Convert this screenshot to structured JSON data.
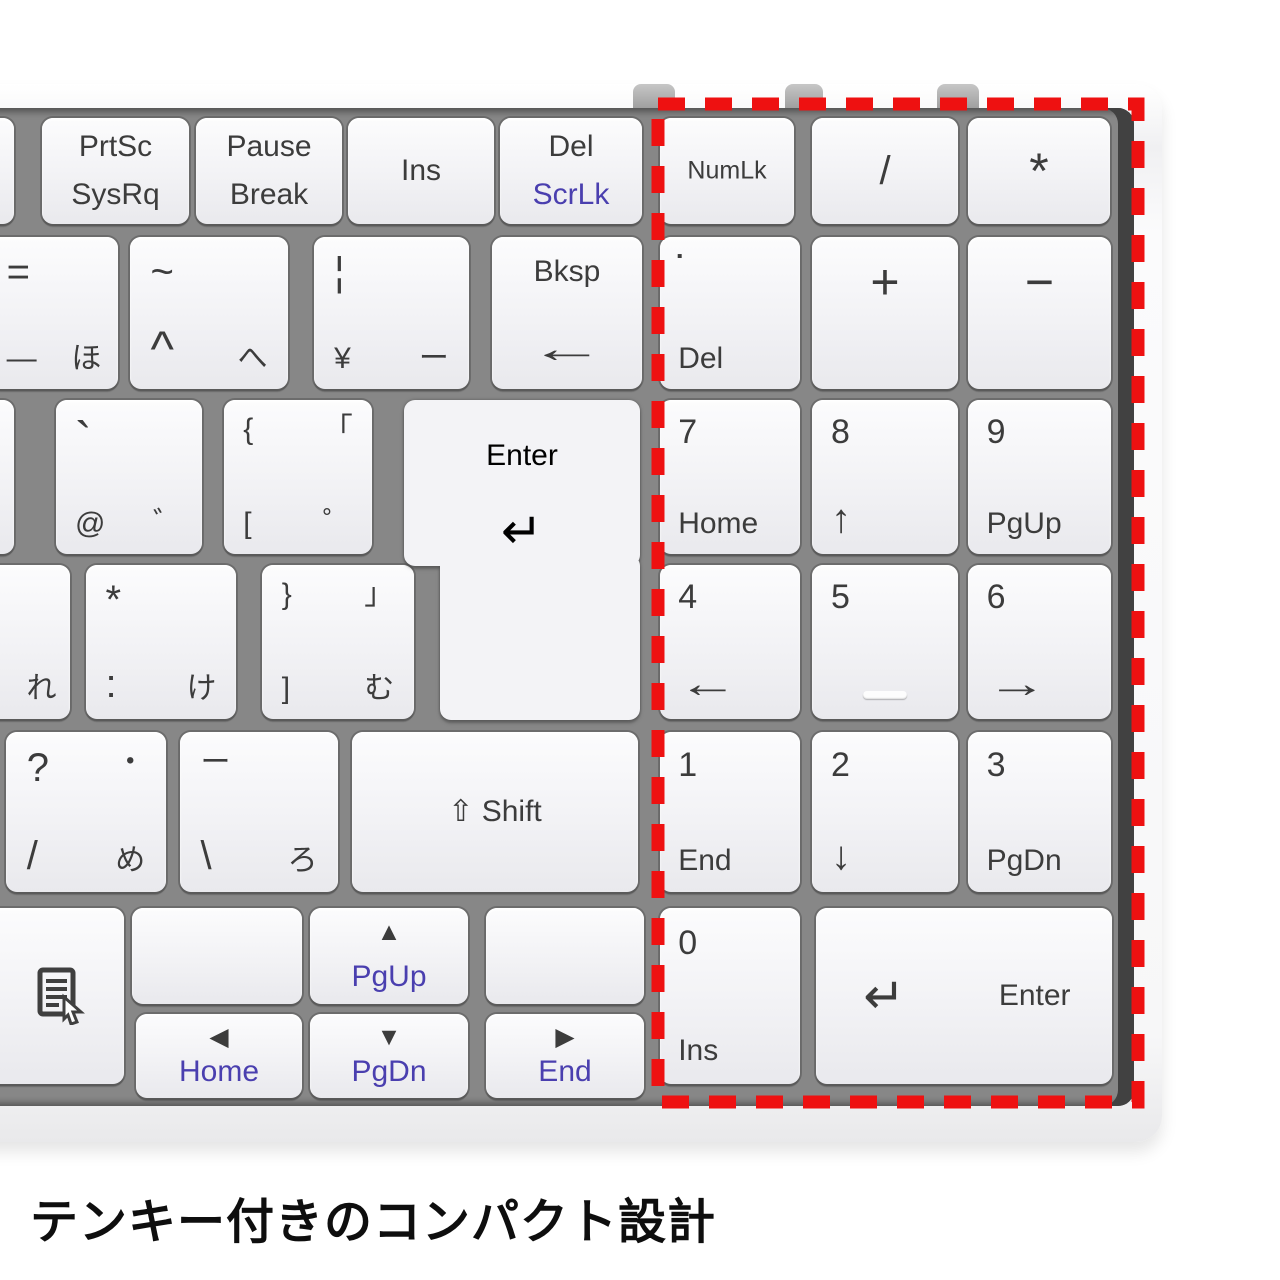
{
  "caption": {
    "text": "テンキー付きのコンパクト設計"
  },
  "annotation": {
    "box_color": "#ee1111"
  },
  "keyboard": {
    "colors": {
      "deck": "#878787",
      "key_face": "#f3f3f6",
      "key_text": "#3c3c3c",
      "accent_blue": "#4a3faf",
      "body": "#f7f7f8"
    },
    "keys": [
      {
        "id": "edge-sliver-top",
        "x": -30,
        "y": 118,
        "w": 44,
        "h": 106,
        "labels": []
      },
      {
        "id": "prtsc-sysrq",
        "x": 42,
        "y": 118,
        "w": 147,
        "h": 106,
        "labels": [
          {
            "t": "PrtSc",
            "p": "ct",
            "s": "md"
          },
          {
            "t": "SysRq",
            "p": "cb",
            "s": "md"
          }
        ]
      },
      {
        "id": "pause-break",
        "x": 196,
        "y": 118,
        "w": 146,
        "h": 106,
        "labels": [
          {
            "t": "Pause",
            "p": "ct",
            "s": "md"
          },
          {
            "t": "Break",
            "p": "cb",
            "s": "md"
          }
        ]
      },
      {
        "id": "ins",
        "x": 348,
        "y": 118,
        "w": 146,
        "h": 106,
        "labels": [
          {
            "t": "Ins",
            "p": "c",
            "s": "md"
          }
        ]
      },
      {
        "id": "del-scrlk",
        "x": 500,
        "y": 118,
        "w": 142,
        "h": 106,
        "labels": [
          {
            "t": "Del",
            "p": "ct",
            "s": "md"
          },
          {
            "t": "ScrLk",
            "p": "cb",
            "s": "md",
            "c": "blue"
          }
        ]
      },
      {
        "id": "minus-ho",
        "x": -10,
        "y": 237,
        "w": 128,
        "h": 152,
        "labels": [
          {
            "t": "=",
            "p": "tl",
            "s": "lg"
          },
          {
            "t": "—",
            "p": "bl",
            "s": "md"
          },
          {
            "t": "ほ",
            "p": "br",
            "s": "md"
          }
        ]
      },
      {
        "id": "caret-he",
        "x": 130,
        "y": 237,
        "w": 158,
        "h": 152,
        "labels": [
          {
            "t": "~",
            "p": "tl",
            "s": "lg"
          },
          {
            "t": "^",
            "p": "bl",
            "s": "xl"
          },
          {
            "t": "へ",
            "p": "br",
            "s": "md"
          }
        ]
      },
      {
        "id": "yen-bar",
        "x": 314,
        "y": 237,
        "w": 155,
        "h": 152,
        "labels": [
          {
            "t": "¦",
            "p": "tl",
            "s": "lg"
          },
          {
            "t": "¥",
            "p": "bl",
            "s": "md"
          },
          {
            "t": "ー",
            "p": "br",
            "s": "md"
          }
        ]
      },
      {
        "id": "bksp",
        "x": 492,
        "y": 237,
        "w": 150,
        "h": 152,
        "labels": [
          {
            "t": "Bksp",
            "p": "ct",
            "s": "md"
          },
          {
            "t": "←",
            "p": "cb",
            "s": "lg",
            "cls": "arrow-wide"
          }
        ]
      },
      {
        "id": "edge-sliver-mid",
        "x": -30,
        "y": 400,
        "w": 44,
        "h": 154,
        "labels": []
      },
      {
        "id": "at-dakuten",
        "x": 56,
        "y": 400,
        "w": 146,
        "h": 154,
        "labels": [
          {
            "t": "`",
            "p": "tl",
            "s": "xl"
          },
          {
            "t": "@",
            "p": "bl",
            "s": "md"
          },
          {
            "t": "゛",
            "p": "br",
            "s": "md"
          }
        ]
      },
      {
        "id": "bracket-open",
        "x": 224,
        "y": 400,
        "w": 148,
        "h": 154,
        "labels": [
          {
            "t": "{",
            "p": "tl",
            "s": "md"
          },
          {
            "t": "「",
            "p": "tr",
            "s": "md"
          },
          {
            "t": "[",
            "p": "bl",
            "s": "md"
          },
          {
            "t": "゜",
            "p": "br",
            "s": "md"
          }
        ]
      },
      {
        "id": "re",
        "x": -34,
        "y": 565,
        "w": 104,
        "h": 154,
        "labels": [
          {
            "t": "れ",
            "p": "br",
            "s": "md"
          }
        ]
      },
      {
        "id": "colon-ke",
        "x": 86,
        "y": 565,
        "w": 150,
        "h": 154,
        "labels": [
          {
            "t": "*",
            "p": "tl",
            "s": "lg"
          },
          {
            "t": ":",
            "p": "bl",
            "s": "lg"
          },
          {
            "t": "け",
            "p": "br",
            "s": "md"
          }
        ]
      },
      {
        "id": "bracket-close",
        "x": 262,
        "y": 565,
        "w": 152,
        "h": 154,
        "labels": [
          {
            "t": "}",
            "p": "tl",
            "s": "md"
          },
          {
            "t": "」",
            "p": "tr",
            "s": "md"
          },
          {
            "t": "]",
            "p": "bl",
            "s": "md"
          },
          {
            "t": "む",
            "p": "br",
            "s": "md"
          }
        ]
      },
      {
        "id": "question-me",
        "x": 6,
        "y": 732,
        "w": 160,
        "h": 160,
        "labels": [
          {
            "t": "?",
            "p": "tl",
            "s": "lg"
          },
          {
            "t": "・",
            "p": "tr",
            "s": "md"
          },
          {
            "t": "/",
            "p": "bl",
            "s": "lg"
          },
          {
            "t": "め",
            "p": "br",
            "s": "md"
          }
        ]
      },
      {
        "id": "ro",
        "x": 180,
        "y": 732,
        "w": 158,
        "h": 160,
        "labels": [
          {
            "t": "ー",
            "p": "tl",
            "s": "md"
          },
          {
            "t": "\\",
            "p": "bl",
            "s": "lg"
          },
          {
            "t": "ろ",
            "p": "br",
            "s": "md"
          }
        ]
      },
      {
        "id": "shift",
        "x": 352,
        "y": 732,
        "w": 286,
        "h": 160,
        "labels": [
          {
            "t": "⇧ Shift",
            "p": "c",
            "s": "md"
          }
        ]
      },
      {
        "id": "menu",
        "x": -42,
        "y": 908,
        "w": 166,
        "h": 176,
        "labels": [],
        "icon": "context-menu"
      },
      {
        "id": "blank-left",
        "x": 132,
        "y": 908,
        "w": 170,
        "h": 96,
        "labels": []
      },
      {
        "id": "up-pgup",
        "x": 310,
        "y": 908,
        "w": 158,
        "h": 96,
        "labels": [
          {
            "t": "▲",
            "p": "ct",
            "s": "sm"
          },
          {
            "t": "PgUp",
            "p": "cb",
            "s": "md",
            "c": "blue"
          }
        ]
      },
      {
        "id": "blank-right",
        "x": 486,
        "y": 908,
        "w": 158,
        "h": 96,
        "labels": []
      },
      {
        "id": "left-home",
        "x": 136,
        "y": 1014,
        "w": 166,
        "h": 84,
        "labels": [
          {
            "t": "◀",
            "p": "ct",
            "s": "sm"
          },
          {
            "t": "Home",
            "p": "cb",
            "s": "md",
            "c": "blue"
          }
        ]
      },
      {
        "id": "down-pgdn",
        "x": 310,
        "y": 1014,
        "w": 158,
        "h": 84,
        "labels": [
          {
            "t": "▼",
            "p": "ct",
            "s": "sm"
          },
          {
            "t": "PgDn",
            "p": "cb",
            "s": "md",
            "c": "blue"
          }
        ]
      },
      {
        "id": "right-end",
        "x": 486,
        "y": 1014,
        "w": 158,
        "h": 84,
        "labels": [
          {
            "t": "▶",
            "p": "ct",
            "s": "sm"
          },
          {
            "t": "End",
            "p": "cb",
            "s": "md",
            "c": "blue"
          }
        ]
      },
      {
        "id": "numlk",
        "x": 660,
        "y": 118,
        "w": 134,
        "h": 106,
        "labels": [
          {
            "t": "NumLk",
            "p": "c",
            "s": "sm"
          }
        ]
      },
      {
        "id": "np-divide",
        "x": 812,
        "y": 118,
        "w": 146,
        "h": 106,
        "labels": [
          {
            "t": "/",
            "p": "c",
            "s": "lg"
          }
        ]
      },
      {
        "id": "np-multiply",
        "x": 968,
        "y": 118,
        "w": 142,
        "h": 106,
        "labels": [
          {
            "t": "*",
            "p": "c",
            "s": "xl"
          }
        ]
      },
      {
        "id": "np-del",
        "x": 660,
        "y": 237,
        "w": 140,
        "h": 152,
        "labels": [
          {
            "t": "▪",
            "p": "tl",
            "s": "sm",
            "cls": "dot-sq"
          },
          {
            "t": "Del",
            "p": "bl",
            "s": "md"
          }
        ]
      },
      {
        "id": "np-plus",
        "x": 812,
        "y": 237,
        "w": 146,
        "h": 152,
        "labels": [
          {
            "t": "+",
            "p": "ct",
            "s": "xl"
          }
        ]
      },
      {
        "id": "np-minus",
        "x": 968,
        "y": 237,
        "w": 143,
        "h": 152,
        "labels": [
          {
            "t": "−",
            "p": "ct",
            "s": "xl"
          }
        ]
      },
      {
        "id": "np-7",
        "x": 660,
        "y": 400,
        "w": 140,
        "h": 154,
        "labels": [
          {
            "t": "7",
            "p": "tl",
            "s": "num"
          },
          {
            "t": "Home",
            "p": "bl",
            "s": "md"
          }
        ]
      },
      {
        "id": "np-8",
        "x": 812,
        "y": 400,
        "w": 146,
        "h": 154,
        "labels": [
          {
            "t": "8",
            "p": "tl",
            "s": "num"
          },
          {
            "t": "↑",
            "p": "bl",
            "s": "lg"
          }
        ]
      },
      {
        "id": "np-9",
        "x": 968,
        "y": 400,
        "w": 143,
        "h": 154,
        "labels": [
          {
            "t": "9",
            "p": "tl",
            "s": "num"
          },
          {
            "t": "PgUp",
            "p": "bl",
            "s": "md"
          }
        ]
      },
      {
        "id": "np-4",
        "x": 660,
        "y": 565,
        "w": 140,
        "h": 154,
        "labels": [
          {
            "t": "←",
            "p": "bl",
            "s": "lg",
            "cls": "arrow-h"
          },
          {
            "t": "4",
            "p": "tl",
            "s": "num"
          }
        ]
      },
      {
        "id": "np-5",
        "x": 812,
        "y": 565,
        "w": 146,
        "h": 154,
        "labels": [
          {
            "t": "5",
            "p": "tl",
            "s": "num"
          },
          {
            "t": "",
            "p": "cb",
            "cls": "homing"
          }
        ]
      },
      {
        "id": "np-6",
        "x": 968,
        "y": 565,
        "w": 143,
        "h": 154,
        "labels": [
          {
            "t": "→",
            "p": "bl",
            "s": "lg",
            "cls": "arrow-h"
          },
          {
            "t": "6",
            "p": "tl",
            "s": "num"
          }
        ]
      },
      {
        "id": "np-1",
        "x": 660,
        "y": 732,
        "w": 140,
        "h": 160,
        "labels": [
          {
            "t": "1",
            "p": "tl",
            "s": "num"
          },
          {
            "t": "End",
            "p": "bl",
            "s": "md"
          }
        ]
      },
      {
        "id": "np-2",
        "x": 812,
        "y": 732,
        "w": 146,
        "h": 160,
        "labels": [
          {
            "t": "2",
            "p": "tl",
            "s": "num"
          },
          {
            "t": "↓",
            "p": "bl",
            "s": "lg"
          }
        ]
      },
      {
        "id": "np-3",
        "x": 968,
        "y": 732,
        "w": 143,
        "h": 160,
        "labels": [
          {
            "t": "3",
            "p": "tl",
            "s": "num"
          },
          {
            "t": "PgDn",
            "p": "bl",
            "s": "md"
          }
        ]
      },
      {
        "id": "np-0",
        "x": 660,
        "y": 908,
        "w": 140,
        "h": 176,
        "labels": [
          {
            "t": "0",
            "p": "tl",
            "s": "num"
          },
          {
            "t": "Ins",
            "p": "bl",
            "s": "md"
          }
        ]
      },
      {
        "id": "np-enter",
        "x": 816,
        "y": 908,
        "w": 296,
        "h": 176,
        "labels": [
          {
            "t": "↵",
            "p": "cl",
            "s": "xl"
          },
          {
            "t": "Enter",
            "p": "cr",
            "s": "md"
          }
        ]
      }
    ],
    "enter_key": {
      "label": "Enter",
      "arrow": "↵",
      "parts": [
        {
          "x": 404,
          "y": 400,
          "w": 236,
          "h": 166
        },
        {
          "x": 440,
          "y": 555,
          "w": 200,
          "h": 165
        }
      ]
    },
    "top_tabs": [
      {
        "x": 633,
        "w": 42
      },
      {
        "x": 785,
        "w": 38
      },
      {
        "x": 937,
        "w": 42
      }
    ],
    "highlight_box": {
      "x": 658,
      "y": 104,
      "w": 480,
      "h": 998
    }
  }
}
